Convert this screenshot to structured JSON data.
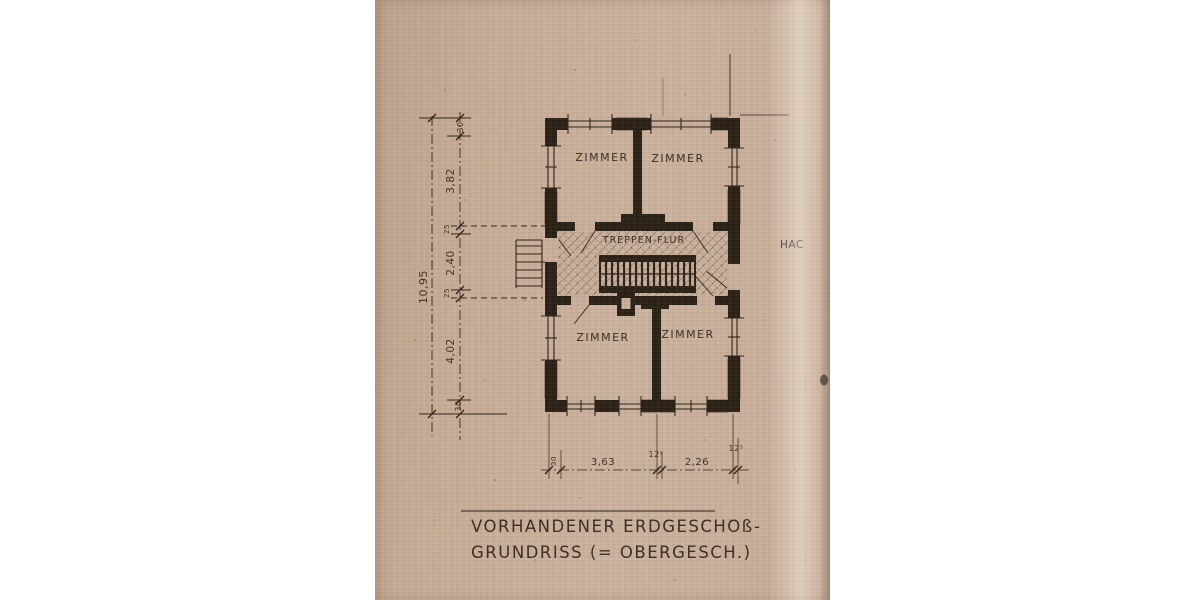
{
  "document": {
    "title_line1": "VORHANDENER ERDGESCHOß-",
    "title_line2": "GRUNDRISS (= OBERGESCH.)",
    "margin_note": "HAC"
  },
  "plan": {
    "rooms": [
      "ZIMMER",
      "ZIMMER",
      "ZIMMER",
      "ZIMMER"
    ],
    "hall_label": "TREPPEN-FLUR",
    "dimensions": {
      "overall": "10,95",
      "left": [
        "30",
        "3,82",
        "25",
        "2,40",
        "25",
        "4,02",
        "30"
      ],
      "bottom": [
        "30",
        "3,63",
        "12⁵",
        "2,26",
        "12⁵"
      ]
    }
  },
  "colors": {
    "paper": "#c9af9a",
    "ink": "#271e13",
    "background": "#ffffff"
  }
}
